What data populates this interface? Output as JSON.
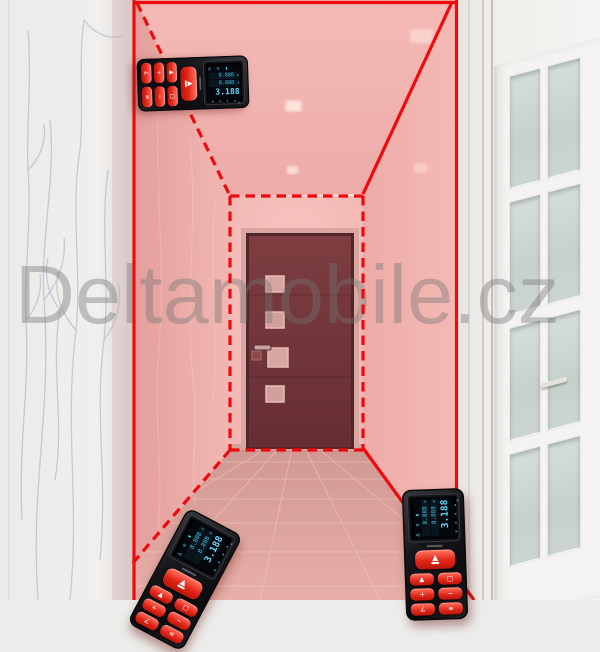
{
  "watermark": {
    "text": "Deltamobile.cz",
    "color": "#757575"
  },
  "colors": {
    "laser_red": "#ee0a0e",
    "hallway_wall_pink": "#eaa7a3",
    "back_wall_pink": "#f6c0bb",
    "ceiling_pink": "#f2b6b2",
    "floor_pink": "#ddA59d",
    "door_maroon": "#6f3439",
    "wallpaper_white": "#ececea",
    "french_door_white": "#f4f3f1",
    "frosted_glass_green": "#ccd5d0",
    "device_body_black": "#17171b",
    "device_button_red": "#e1261a",
    "display_cyan": "#49ccf4"
  },
  "devices": {
    "display": {
      "status_icons": "∆ ≡ ▮",
      "history": [
        {
          "value": "8.888",
          "unit": "m"
        },
        {
          "value": "8.888",
          "unit": "m"
        }
      ],
      "main": {
        "value": "3.188",
        "unit": "m"
      },
      "softkeys": "▪ ▪ ▪ ▪"
    },
    "buttons": {
      "small_glyphs": [
        "▲",
        "□",
        "+",
        "−",
        "∠",
        "≡"
      ]
    },
    "instances": [
      {
        "id": "top-left",
        "orientation": "horizontal"
      },
      {
        "id": "bottom-center",
        "orientation": "tilted"
      },
      {
        "id": "bottom-right",
        "orientation": "vertical"
      }
    ]
  }
}
